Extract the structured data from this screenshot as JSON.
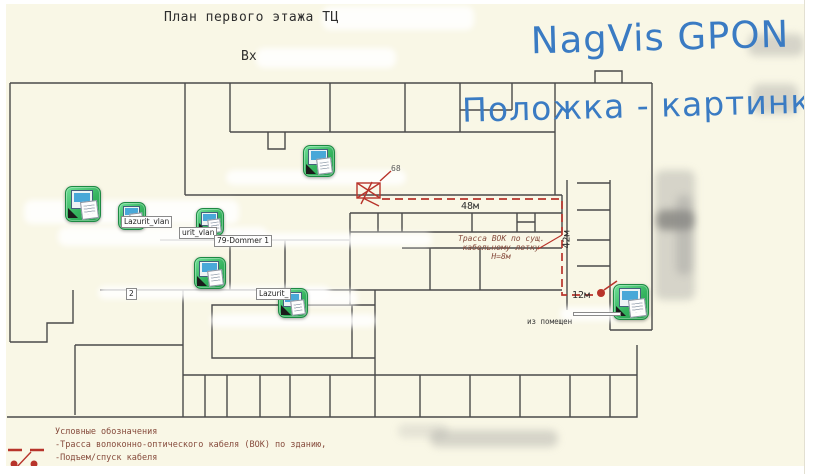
{
  "overlay": {
    "line1": "NagVis GPON",
    "line2": "Положка - картинка"
  },
  "drawing": {
    "title": "План первого этажа ТЦ",
    "entrance_label": "Вх",
    "junction_number": "68",
    "room_exit_text": "из помещен",
    "measure_horizontal": "48м",
    "measure_vertical": "42м",
    "measure_segment": "12м",
    "route_note_line1": "Трасса ВОК по сущ.",
    "route_note_line2": "кабельному лотку",
    "route_note_line3": "Н=8м"
  },
  "hosts": [
    {
      "id": "host-1",
      "x": 82,
      "y": 203,
      "size": 34
    },
    {
      "id": "host-2",
      "x": 131,
      "y": 215,
      "size": 26
    },
    {
      "id": "host-3",
      "x": 209,
      "y": 221,
      "size": 26
    },
    {
      "id": "host-4",
      "x": 318,
      "y": 160,
      "size": 30
    },
    {
      "id": "host-5",
      "x": 209,
      "y": 272,
      "size": 30
    },
    {
      "id": "host-6",
      "x": 292,
      "y": 302,
      "size": 28
    },
    {
      "id": "host-7",
      "x": 630,
      "y": 301,
      "size": 34
    }
  ],
  "host_labels": [
    {
      "text": "Lazurit_vlan",
      "x": 121,
      "y": 216
    },
    {
      "text": "urit_vlan",
      "x": 179,
      "y": 227
    },
    {
      "text": "79-Dommer 1",
      "x": 214,
      "y": 235
    },
    {
      "text": "2",
      "x": 126,
      "y": 288
    },
    {
      "text": "Lazurit_",
      "x": 256,
      "y": 288
    },
    {
      "text": "",
      "x": 573,
      "y": 312,
      "min_width": 42
    }
  ],
  "legend": {
    "heading": "Условные обозначения",
    "items": [
      {
        "symbol": "red-dashed-line",
        "text": "-Трасса волоконно-оптического кабеля (ВОК) по зданию,"
      },
      {
        "symbol": "red-dot-rise",
        "text": "-Подъем/спуск кабеля"
      }
    ]
  },
  "colors": {
    "marker_blue": "#3a7bc3",
    "route_red": "#b8342b",
    "host_green": "#35b35e",
    "paper": "#f9f7e6",
    "wall": "#4a4a4a",
    "legend_text": "#864b3c"
  }
}
